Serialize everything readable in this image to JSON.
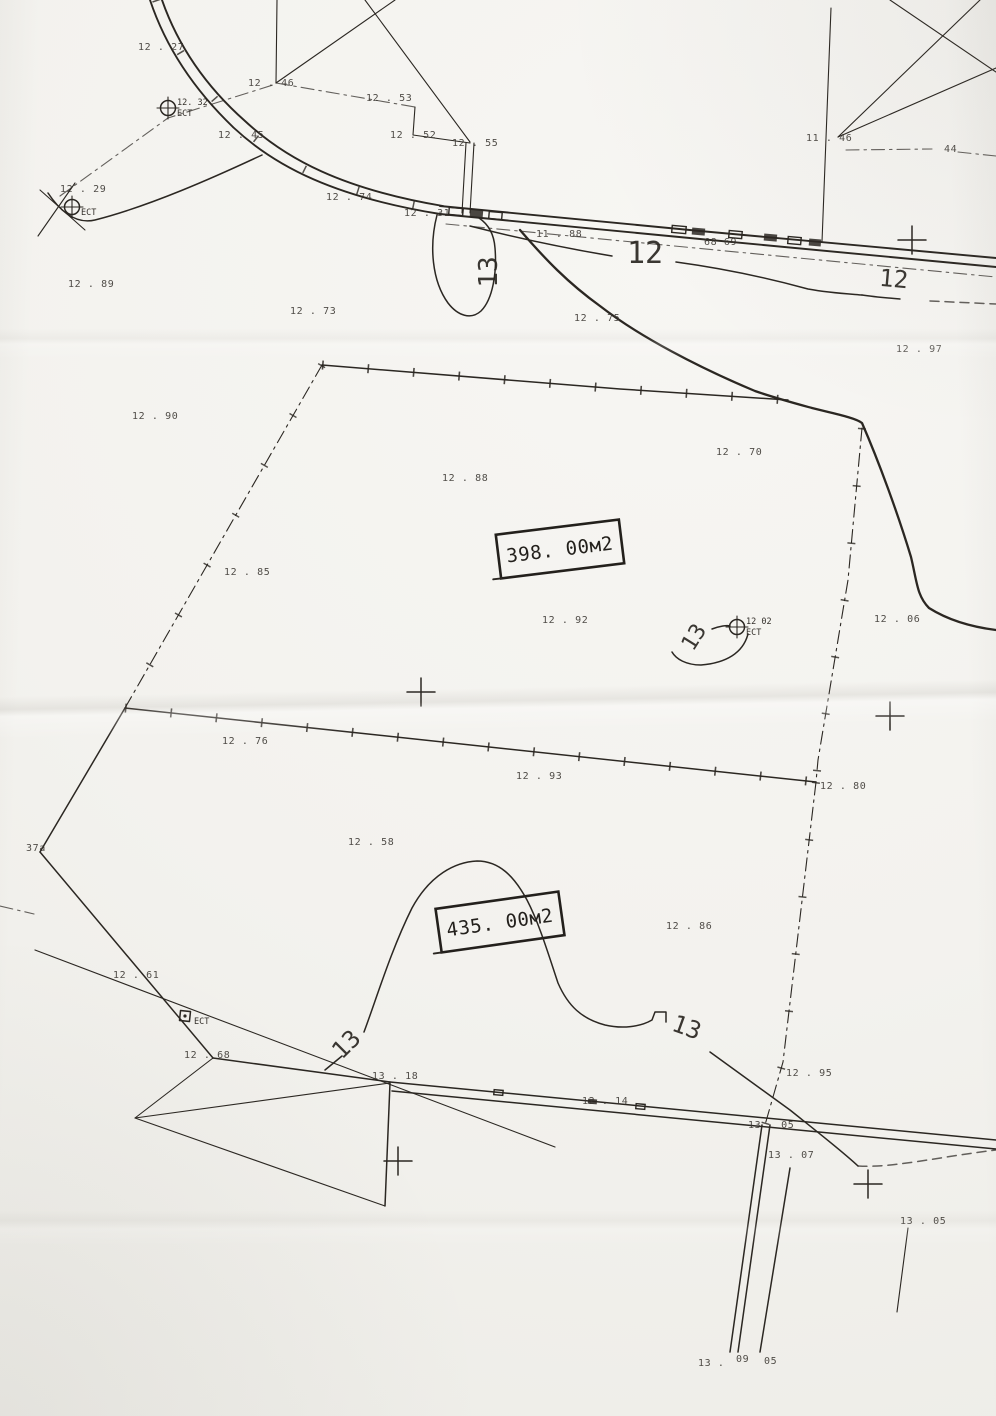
{
  "page": {
    "paper_color": "#f3f2ee",
    "ink_color": "#2b2722",
    "kind": "scanned cadastral survey sketch"
  },
  "map": {
    "area_labels": [
      {
        "text": "398. 00м2",
        "x": 560,
        "y": 549,
        "rot": -7
      },
      {
        "text": "435. 00м2",
        "x": 500,
        "y": 922,
        "rot": -8
      }
    ],
    "contour_labels": [
      {
        "text": "12",
        "x": 645,
        "y": 263,
        "rot": 0,
        "size": 30
      },
      {
        "text": "12",
        "x": 893,
        "y": 287,
        "rot": 5,
        "size": 24
      },
      {
        "text": "13",
        "x": 497,
        "y": 272,
        "rot": -90,
        "size": 26
      },
      {
        "text": "13",
        "x": 700,
        "y": 641,
        "rot": -58,
        "size": 22
      },
      {
        "text": "13",
        "x": 352,
        "y": 1050,
        "rot": -45,
        "size": 24
      },
      {
        "text": "13",
        "x": 684,
        "y": 1035,
        "rot": 20,
        "size": 24
      }
    ],
    "spot_heights": [
      {
        "x": 138,
        "y": 50,
        "t": "12 . 27"
      },
      {
        "x": 248,
        "y": 86,
        "t": "12 . 46"
      },
      {
        "x": 366,
        "y": 101,
        "t": "12 . 53"
      },
      {
        "x": 390,
        "y": 138,
        "t": "12 . 52"
      },
      {
        "x": 452,
        "y": 146,
        "t": "12 . 55"
      },
      {
        "x": 218,
        "y": 138,
        "t": "12 . 45"
      },
      {
        "x": 806,
        "y": 141,
        "t": "11 . 46"
      },
      {
        "x": 944,
        "y": 152,
        "t": "44"
      },
      {
        "x": 60,
        "y": 192,
        "t": "12 . 29"
      },
      {
        "x": 326,
        "y": 200,
        "t": "12 . 74"
      },
      {
        "x": 404,
        "y": 216,
        "t": "12 . 31"
      },
      {
        "x": 536,
        "y": 237,
        "t": "11 . 88"
      },
      {
        "x": 704,
        "y": 245,
        "t": "68 69"
      },
      {
        "x": 68,
        "y": 287,
        "t": "12 . 89"
      },
      {
        "x": 290,
        "y": 314,
        "t": "12 . 73"
      },
      {
        "x": 574,
        "y": 321,
        "t": "12 . 75"
      },
      {
        "x": 896,
        "y": 352,
        "t": "12 . 97"
      },
      {
        "x": 132,
        "y": 419,
        "t": "12 . 90"
      },
      {
        "x": 716,
        "y": 455,
        "t": "12 . 70"
      },
      {
        "x": 442,
        "y": 481,
        "t": "12 . 88"
      },
      {
        "x": 224,
        "y": 575,
        "t": "12 . 85"
      },
      {
        "x": 542,
        "y": 623,
        "t": "12 . 92"
      },
      {
        "x": 874,
        "y": 622,
        "t": "12 . 06"
      },
      {
        "x": 222,
        "y": 744,
        "t": "12 . 76"
      },
      {
        "x": 516,
        "y": 779,
        "t": "12 . 93"
      },
      {
        "x": 820,
        "y": 789,
        "t": "12 . 80"
      },
      {
        "x": 348,
        "y": 845,
        "t": "12 . 58"
      },
      {
        "x": 26,
        "y": 851,
        "t": "37a"
      },
      {
        "x": 666,
        "y": 929,
        "t": "12 . 86"
      },
      {
        "x": 113,
        "y": 978,
        "t": "12 . 61"
      },
      {
        "x": 184,
        "y": 1058,
        "t": "12 . 68"
      },
      {
        "x": 372,
        "y": 1079,
        "t": "13 . 18"
      },
      {
        "x": 582,
        "y": 1104,
        "t": "12 . 14"
      },
      {
        "x": 786,
        "y": 1076,
        "t": "12 . 95"
      },
      {
        "x": 748,
        "y": 1128,
        "t": "13 . 05"
      },
      {
        "x": 768,
        "y": 1158,
        "t": "13 . 07"
      },
      {
        "x": 900,
        "y": 1224,
        "t": "13 . 05"
      },
      {
        "x": 698,
        "y": 1366,
        "t": "13 ."
      },
      {
        "x": 736,
        "y": 1362,
        "t": "09"
      },
      {
        "x": 764,
        "y": 1364,
        "t": "05"
      }
    ],
    "survey_markers": [
      {
        "x": 168,
        "y": 108,
        "shape": "circle",
        "label_top": "12. 32",
        "label_bottom": "ЕСТ"
      },
      {
        "x": 72,
        "y": 207,
        "shape": "circle",
        "label_top": "",
        "label_bottom": "ЕСТ"
      },
      {
        "x": 737,
        "y": 627,
        "shape": "circle",
        "label_top": "12 02",
        "label_bottom": "ЕСТ"
      },
      {
        "x": 185,
        "y": 1016,
        "shape": "square",
        "label_top": "",
        "label_bottom": "ЕСТ"
      }
    ],
    "grid_crosses": [
      {
        "x": 912,
        "y": 240
      },
      {
        "x": 421,
        "y": 692
      },
      {
        "x": 890,
        "y": 716
      },
      {
        "x": 398,
        "y": 1161
      },
      {
        "x": 868,
        "y": 1184
      }
    ]
  }
}
